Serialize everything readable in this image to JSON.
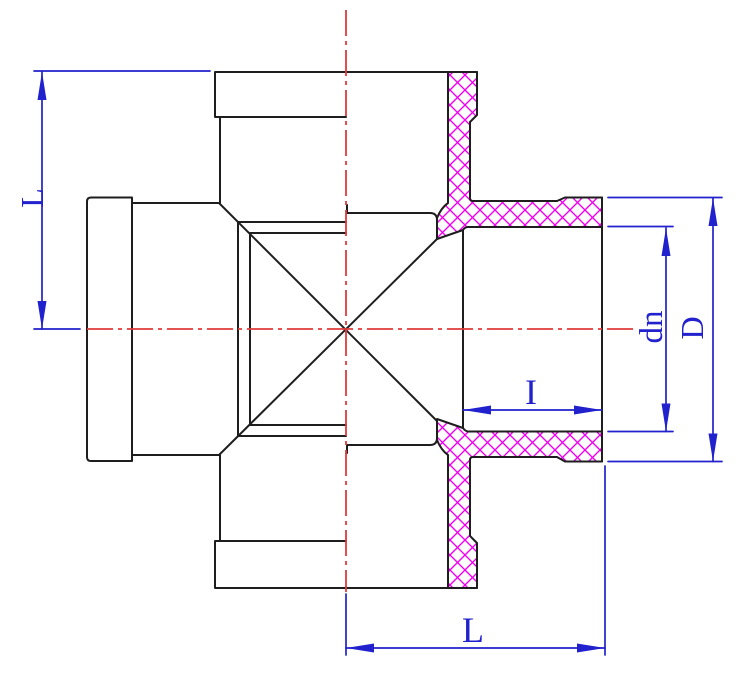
{
  "drawing": {
    "title": "Cross pipe fitting half-section drawing",
    "labels": {
      "dim_L_left": "L",
      "dim_L_bottom": "L",
      "dim_I": "I",
      "dim_dn": "dn",
      "dim_D": "D"
    },
    "colors": {
      "background": "#ffffff",
      "outline": "#1e1e1e",
      "dimension": "#2121cd",
      "centerline": "#e13a3a",
      "hatch": "#ee00ee"
    }
  }
}
